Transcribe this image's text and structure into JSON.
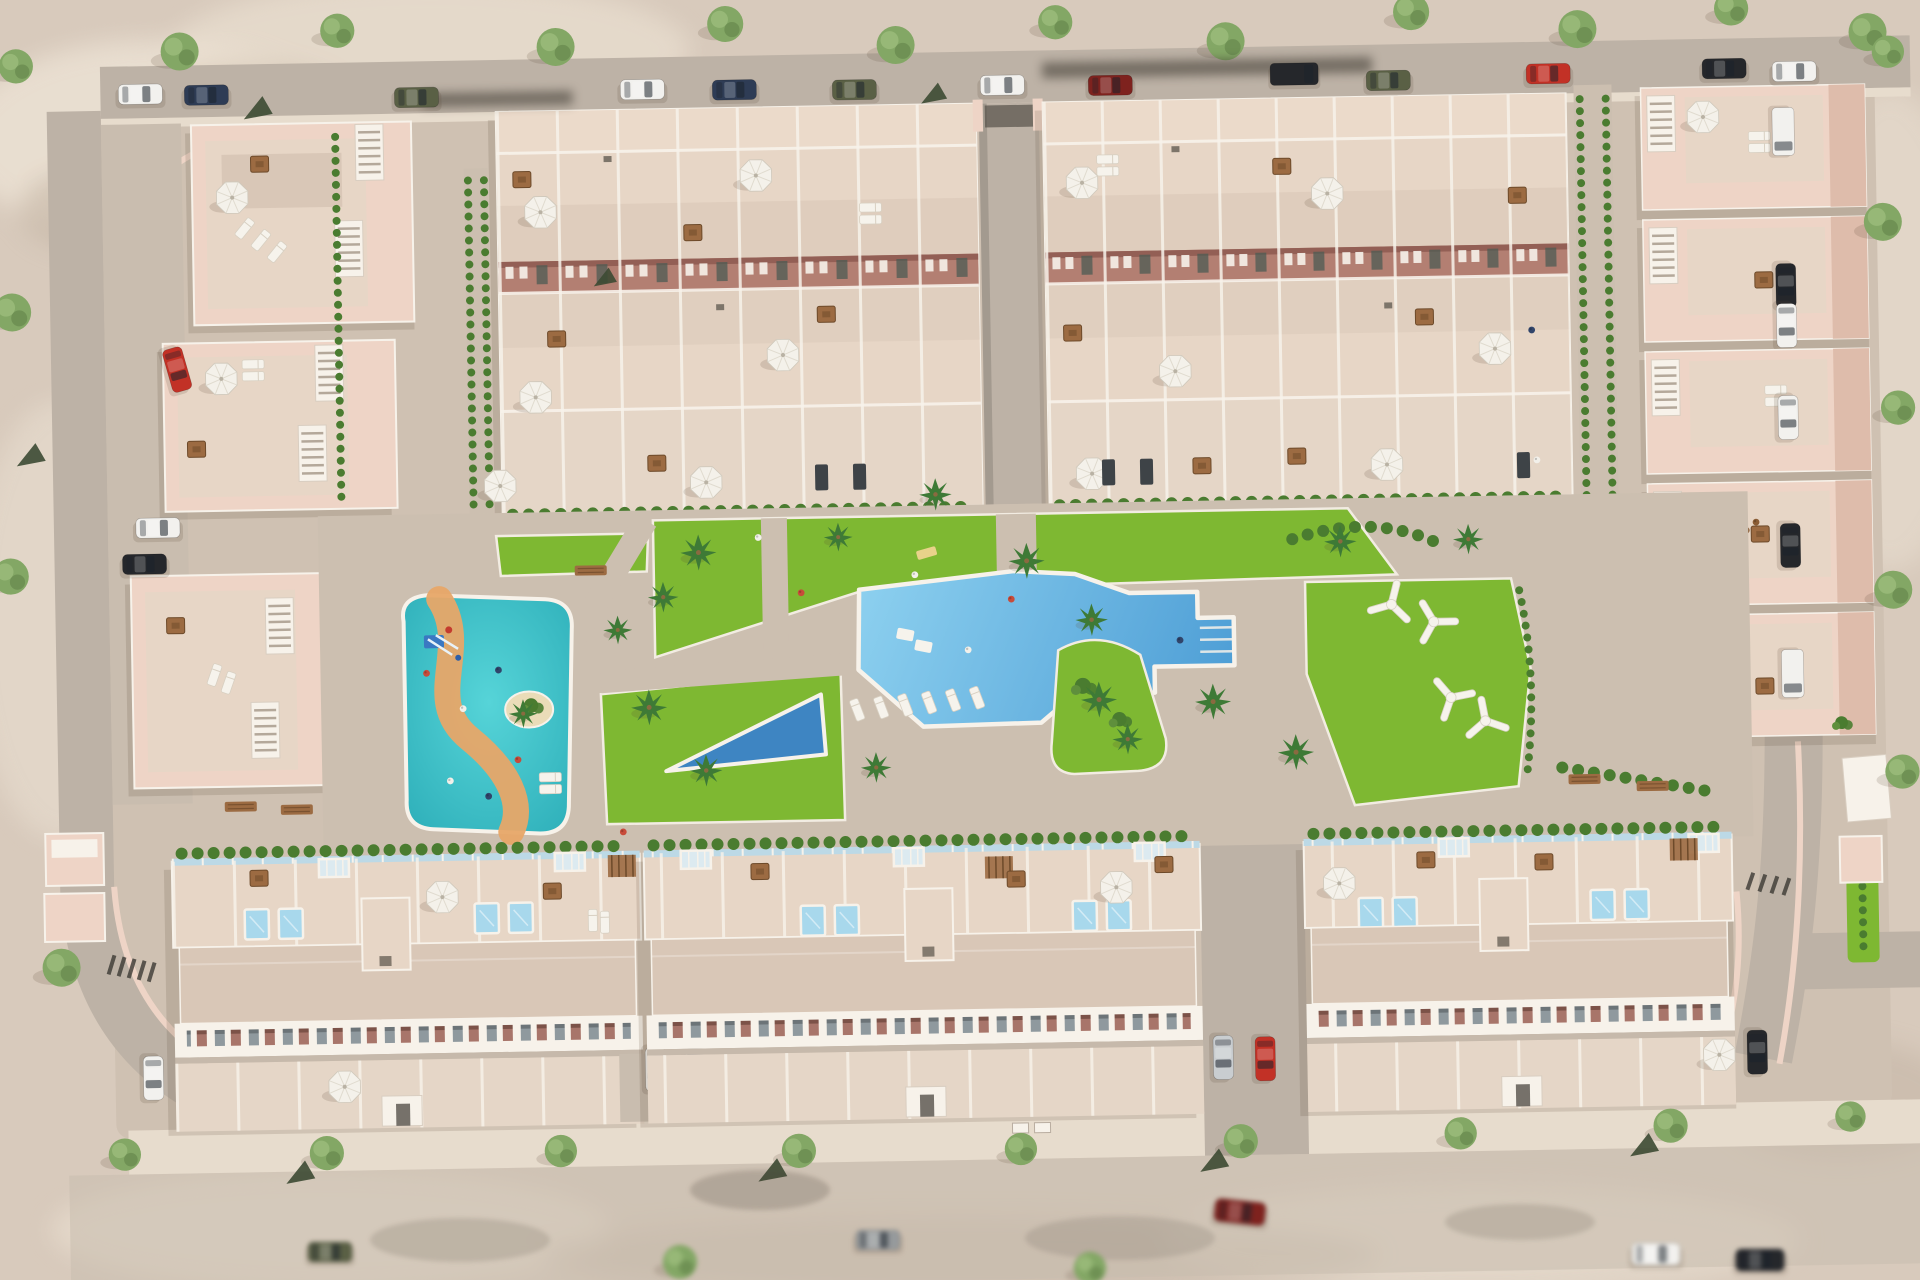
{
  "meta": {
    "title": "Aerial 3D masterplan render - residential resort development",
    "description": "Bird's-eye 3D architectural visualization of a gated residential development: two large blocks of back-to-back townhouses at the top, three apartment buildings on the left, a column of detached villas on the right, three long townhouse rows at the bottom, and a central landscaped park with a large freeform swimming pool, a children's splash lagoon with winding orange path and slides, lawns, palm trees, white chill-out seats, and perimeter streets lined with trees and parked cars."
  },
  "palette": {
    "sand": "#d8cabc",
    "sand_light": "#ece2d4",
    "shadow": "#55432f",
    "road": "#bdb2a6",
    "road_light": "#c9bdaf",
    "sidewalk": "#e7dccd",
    "plaza": "#cfc1b2",
    "park_path": "#ccbfb0",
    "wall_pink": "#eed4c6",
    "wall_pink_dark": "#debcab",
    "roof": "#d9c7b7",
    "roof_light": "#e7d6c6",
    "patio": "#ebdaca",
    "front_strip": "#e5d6c7",
    "white": "#f7f2ea",
    "sill": "#c6b9ab",
    "facade_band": "#b37f72",
    "facade_band_dark": "#935f55",
    "window_gray": "#8f999e",
    "window_rust": "#a8756a",
    "door_dark": "#4c5a52",
    "lawn": "#7eb832",
    "hedge": "#4a7c30",
    "palm": "#3e7a36",
    "tree": "#83a765",
    "tree_light": "#9cbd7c",
    "cypress": "#3c4a33",
    "pool_main_light": "#8fd2f0",
    "pool_main_deep": "#4a9bd4",
    "pool_kids": "#3cc6cd",
    "pool_kids_deep": "#2fb0ba",
    "pool_wedge": "#3e85c2",
    "glass": "#bcd9e6",
    "path_orange": "#e7a768",
    "island_sand": "#eadcb8",
    "wood": "#9c6b42",
    "umbrella": "#f4f1ea",
    "car_white": "#f2f1ee",
    "car_silver": "#c9cdd0",
    "car_black": "#25272b",
    "car_red": "#c23126",
    "car_darkred": "#7e221e",
    "car_olive": "#5a6045",
    "car_navy": "#2e3c55",
    "car_gray": "#969a9c"
  },
  "scene": {
    "buildings": {
      "top_townhouse_blocks": 2,
      "bottom_townhouse_rows": 3,
      "apartment_buildings_left": 3,
      "detached_villas_right": 5
    },
    "amenities": [
      "main freeform swimming pool",
      "tanning ledge with in-pool loungers",
      "lap pool wedge",
      "children splash lagoon",
      "water slide playground",
      "palm island",
      "sun lounger row",
      "white chill-out X-seats",
      "lawn gardens",
      "hedged pedestrian alleys",
      "rooftop plunge pools",
      "roof terraces with umbrellas and pergolas",
      "benches"
    ],
    "parked_cars": {
      "top_street": 13,
      "left_inner_driveway": 3,
      "villa_driveways": 5,
      "bottom_rows_and_bays": 6,
      "bottom_street_blurred": 4
    },
    "landscape": {
      "street_trees": 24,
      "palm_trees": 16,
      "hedge_rows": "along building fronts and alleys"
    }
  }
}
